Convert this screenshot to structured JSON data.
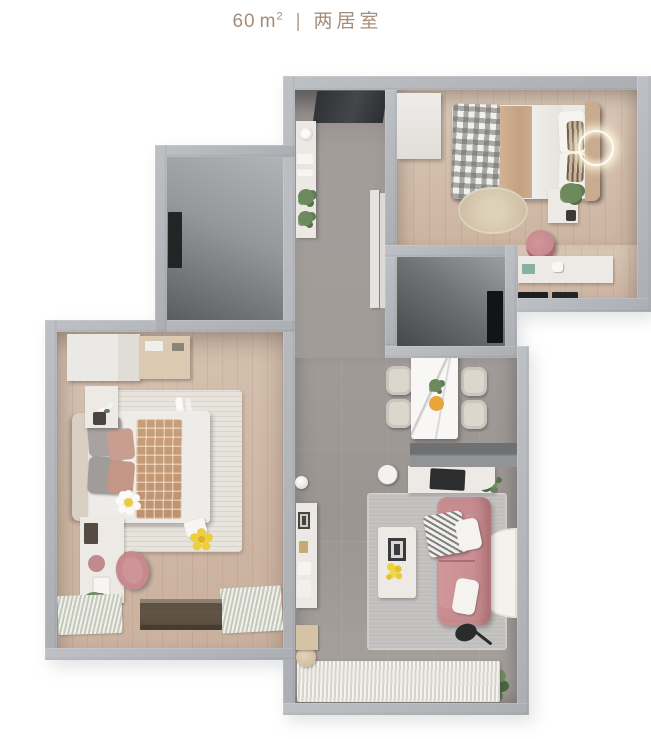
{
  "header": {
    "area_value": "60",
    "area_unit": "m",
    "area_sup": "2",
    "divider": "|",
    "home_type": "两居室"
  },
  "plan": {
    "palette": {
      "title_text": "#a48d7a",
      "wall": "#b3b6bb",
      "wood_floor": "#d3bfae",
      "tile_floor": "#a29c99",
      "dark_room": "#5b5d60",
      "entry_mat": "#3b3e41",
      "sofa_pink": "#c78d90",
      "chair_pink": "#c6898d",
      "dining_chair_beige": "#dbd7cd",
      "marble_table": "#f8f7f5",
      "cream_furniture": "#edeae5",
      "rug_cream": "#e7e4dd",
      "rug_gray": "#c1bfbe",
      "jute_rug": "#d3c5aa",
      "plant_green": "#6d8a5e",
      "flower_yellow": "#eed23e",
      "blanket_tan_plaid": "#c89f7b",
      "blanket_gray_plaid": "#8b8b89"
    },
    "rooms": [
      {
        "id": "bedroom-right",
        "furniture": [
          "wardrobe",
          "double-bed",
          "plaid-blanket",
          "headboard",
          "wall-light",
          "round-jute-rug",
          "nightstand",
          "plant",
          "desk",
          "desk-chair"
        ]
      },
      {
        "id": "bedroom-left",
        "furniture": [
          "wardrobe",
          "open-shelf",
          "double-bed",
          "tan-plaid-blanket",
          "daisy-pillow",
          "area-rug",
          "slippers",
          "nightstand",
          "desk",
          "desk-chair",
          "window-blinds",
          "yellow-flower-cushion"
        ]
      },
      {
        "id": "hallway",
        "furniture": [
          "entry-mat",
          "wall-shelf",
          "plants",
          "door-panels"
        ]
      },
      {
        "id": "dining-area",
        "furniture": [
          "marble-dining-table",
          "dining-chair-1",
          "dining-chair-2",
          "dining-chair-3",
          "dining-chair-4",
          "fruit-plate",
          "table-plant"
        ]
      },
      {
        "id": "living-area",
        "furniture": [
          "tv-console",
          "tv",
          "pink-sofa",
          "throw-blanket",
          "pillows",
          "coffee-table",
          "photo-frame",
          "yellow-flowers",
          "area-rug",
          "half-round-rug",
          "floor-lamp",
          "floor-plant",
          "wall-shelf",
          "round-side-table",
          "ball-lamp",
          "stool",
          "side-cabinet",
          "balcony-ribbed-mat"
        ]
      },
      {
        "id": "utility-room-top-left",
        "furniture": [
          "wall-panel"
        ]
      },
      {
        "id": "utility-room-center",
        "furniture": [
          "door-panel"
        ]
      }
    ]
  }
}
